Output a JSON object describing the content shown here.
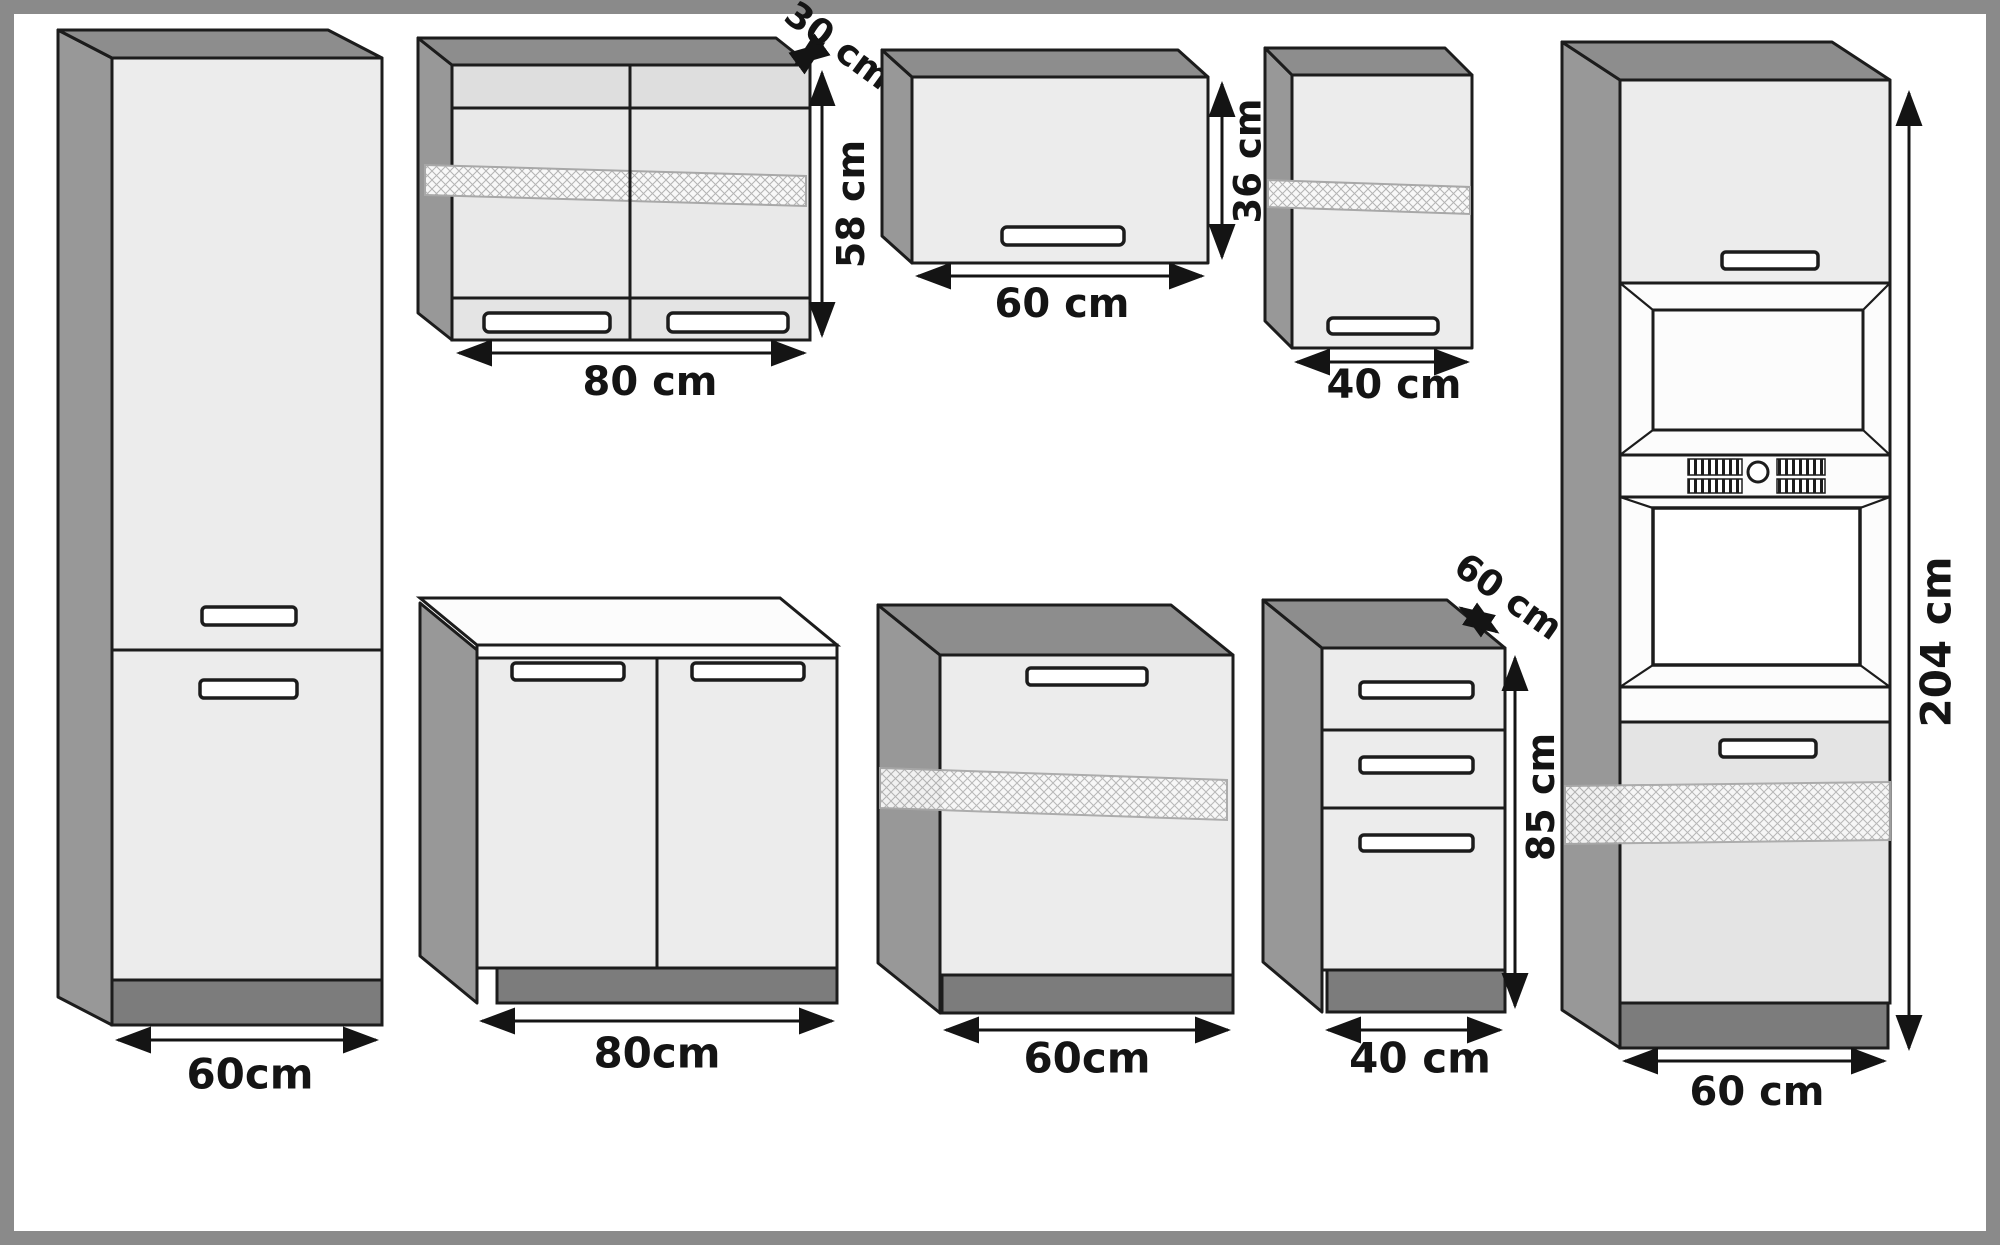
{
  "diagram": {
    "kind": "kitchen-cabinet-dimension-drawing",
    "units": "cm"
  },
  "labels": {
    "tall_left": {
      "width": "60cm"
    },
    "wall_glass_80": {
      "depth": "30 cm",
      "height": "58 cm",
      "width": "80 cm"
    },
    "wall_flap_60": {
      "width": "60 cm",
      "height": "36 cm"
    },
    "wall_40": {
      "width": "40 cm"
    },
    "base_80": {
      "width": "80cm"
    },
    "base_60": {
      "width": "60cm"
    },
    "drawer_40": {
      "depth": "60 cm",
      "height": "85 cm",
      "width": "40 cm"
    },
    "tall_oven": {
      "height": "204 cm",
      "width": "60 cm"
    }
  },
  "colors": {
    "frame": "#8a8a8a",
    "line": "#1c1c1c",
    "front": "#ececec",
    "side": "#989898",
    "top": "#8d8d8d",
    "plinth": "#7c7c7c",
    "worktop": "#fcfcfc",
    "text": "#141414"
  }
}
